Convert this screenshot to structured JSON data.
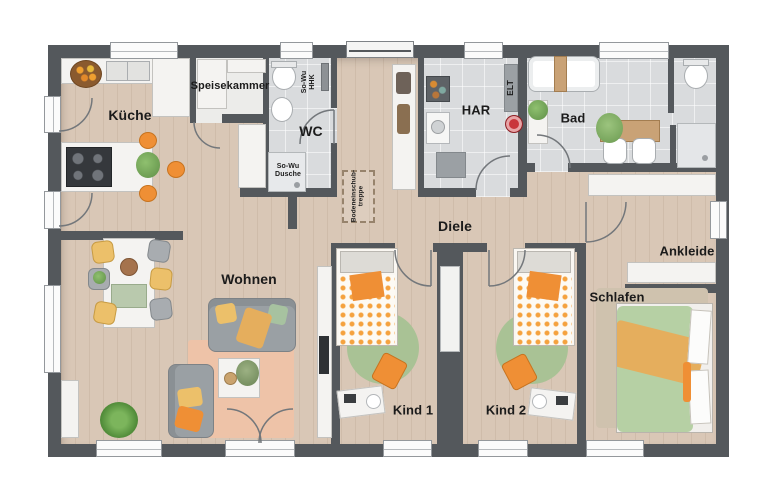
{
  "labels": {
    "kueche": "Küche",
    "speisekammer": "Speisekammer",
    "wc": "WC",
    "har": "HAR",
    "bad": "Bad",
    "diele": "Diele",
    "wohnen": "Wohnen",
    "kind1": "Kind 1",
    "kind2": "Kind 2",
    "schlafen": "Schlafen",
    "ankleide": "Ankleide"
  },
  "annotations": {
    "shower_special": "So-Wu\nDusche",
    "towel_radiator": "So-Wu\nHHK",
    "electrical": "ELT",
    "attic_stairs": "Bodeneinschub-\ntreppe"
  },
  "colors": {
    "wall": "#54585c",
    "wood_floor": "#d9c7b6",
    "tile_floor": "#d9dbdd",
    "pantry_floor": "#ececea",
    "accent_orange": "#ef8f35",
    "accent_yellow": "#ecc06a",
    "rug_green": "#a9c295",
    "bed_green": "#b6d0a4",
    "rug_peach": "#eec3a8",
    "robot_red": "#c9353b"
  }
}
